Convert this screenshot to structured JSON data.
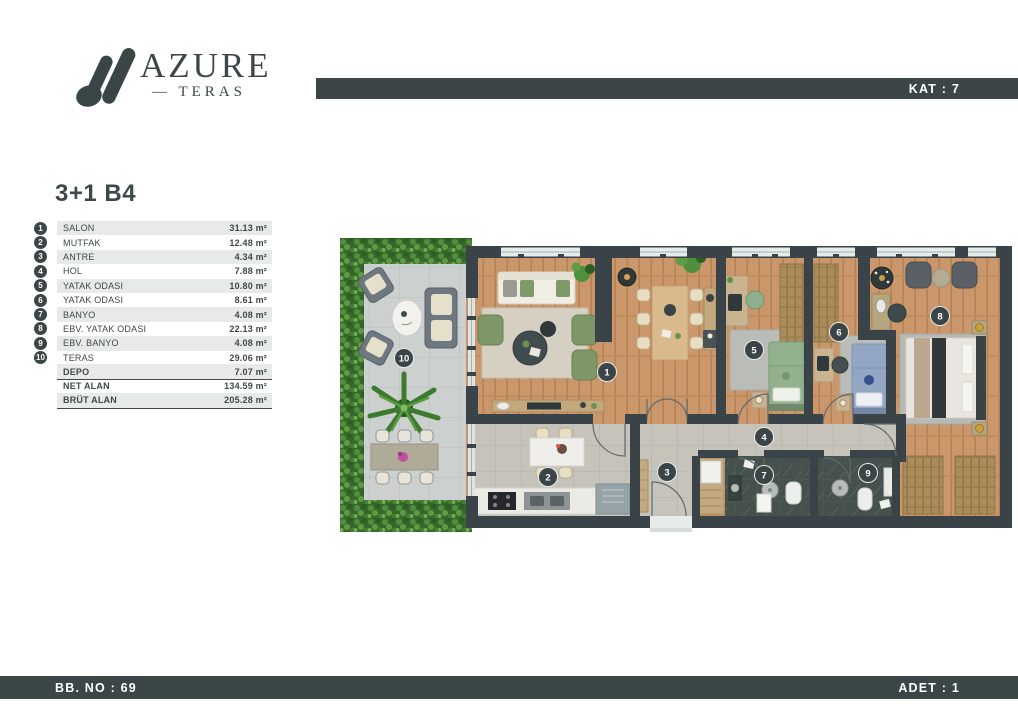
{
  "header": {
    "logo_title": "AZURE",
    "logo_subtitle": "— TERAS",
    "kat_label": "KAT : 7"
  },
  "plan": {
    "title": "3+1 B4"
  },
  "rooms": [
    {
      "no": "1",
      "label": "SALON",
      "area": "31.13 m²"
    },
    {
      "no": "2",
      "label": "MUTFAK",
      "area": "12.48 m²"
    },
    {
      "no": "3",
      "label": "ANTRE",
      "area": "4.34 m²"
    },
    {
      "no": "4",
      "label": "HOL",
      "area": "7.88 m²"
    },
    {
      "no": "5",
      "label": "YATAK ODASI",
      "area": "10.80 m²"
    },
    {
      "no": "6",
      "label": "YATAK ODASI",
      "area": "8.61 m²"
    },
    {
      "no": "7",
      "label": "BANYO",
      "area": "4.08 m²"
    },
    {
      "no": "8",
      "label": "EBV. YATAK ODASI",
      "area": "22.13 m²"
    },
    {
      "no": "9",
      "label": "EBV. BANYO",
      "area": "4.08 m²"
    },
    {
      "no": "10",
      "label": "TERAS",
      "area": "29.06 m²"
    }
  ],
  "summary": [
    {
      "label": "DEPO",
      "area": "7.07 m²"
    },
    {
      "label": "NET ALAN",
      "area": "134.59 m²"
    },
    {
      "label": "BRÜT ALAN",
      "area": "205.28 m²"
    }
  ],
  "footer": {
    "bb_no": "BB. NO : 69",
    "adet": "ADET : 1"
  },
  "floorplan": {
    "markers": [
      "1",
      "2",
      "3",
      "4",
      "5",
      "6",
      "7",
      "8",
      "9",
      "10"
    ]
  },
  "colors": {
    "accent_dark": "#3c4647",
    "row_alt": "#e8eae9",
    "wood": "#c9976b",
    "tile": "#c6c4ba",
    "terrace_tile": "#ccd0ce",
    "plant_green": "#4f8f3d",
    "dark_tile": "#46514d",
    "bed_green": "#93b08f",
    "bed_blue": "#93a6c4"
  }
}
